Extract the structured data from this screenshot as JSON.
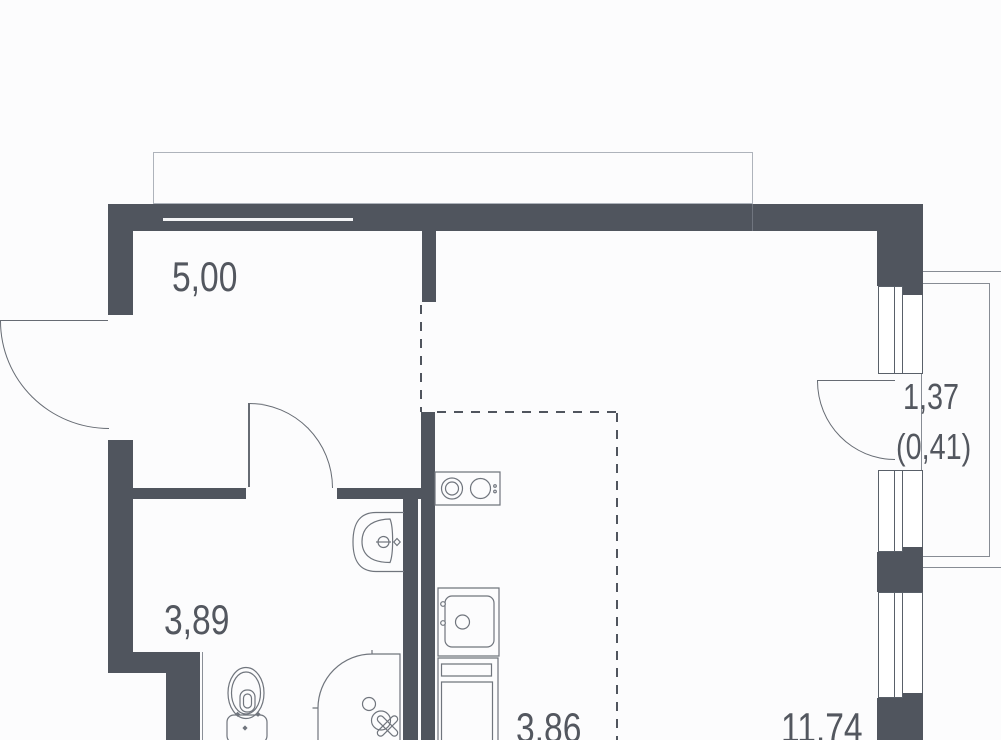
{
  "page": {
    "title": "Apartment floor plan"
  },
  "plan": {
    "kind": "studio-apartment-floor-plan",
    "labels": {
      "hallway": "5,00",
      "bathroom": "3,89",
      "kitchen": "3,86",
      "living": "11,74",
      "balcony": "1,37",
      "balcony_reduced": "(0,41)"
    },
    "colors": {
      "wall": "#50555e",
      "fixture_line": "#70757d",
      "window_line": "#596069",
      "balcony_line": "#878c94",
      "outline_light": "#aeb3bb",
      "text": "#53575f",
      "background": "#fcfcfd"
    },
    "fixtures": [
      "entry-door",
      "bathroom-door",
      "balcony-door",
      "window-top",
      "window-middle",
      "window-bottom",
      "cooktop",
      "kitchen-sink",
      "refrigerator",
      "toilet",
      "washbasin",
      "shower"
    ]
  }
}
